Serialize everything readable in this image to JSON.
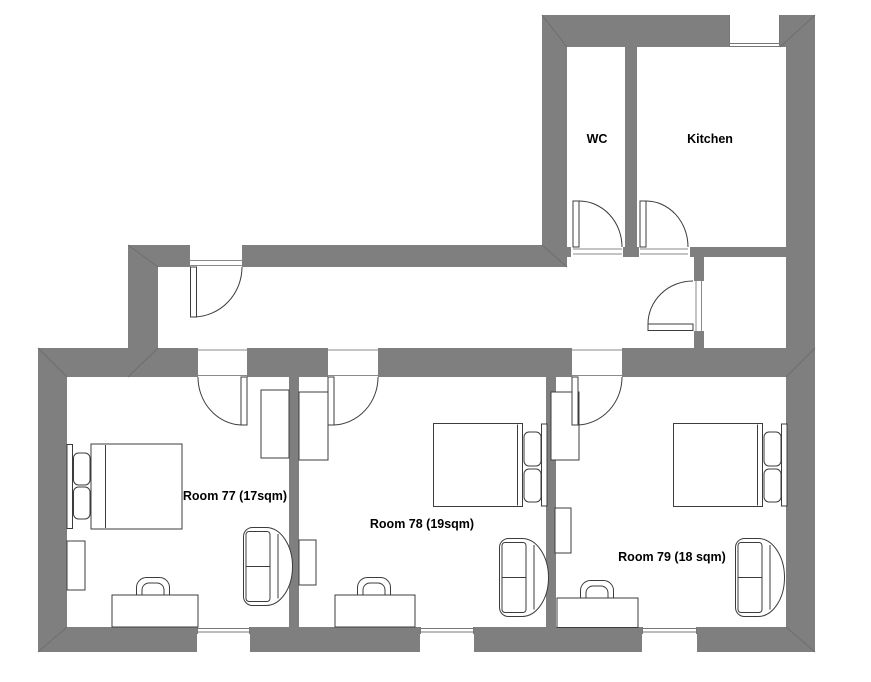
{
  "plan": {
    "type": "apartment-floor-plan",
    "colors": {
      "wall": "#7f7f7f",
      "line": "#3c3c3c",
      "fill": "#ffffff",
      "frame": "#8a8a8a",
      "text": "#000000"
    },
    "rooms": [
      {
        "name": "WC"
      },
      {
        "name": "Kitchen"
      },
      {
        "name": "Room 77 (17sqm)"
      },
      {
        "name": "Room 78 (19sqm)"
      },
      {
        "name": "Room 79 (18 sqm)"
      }
    ]
  }
}
